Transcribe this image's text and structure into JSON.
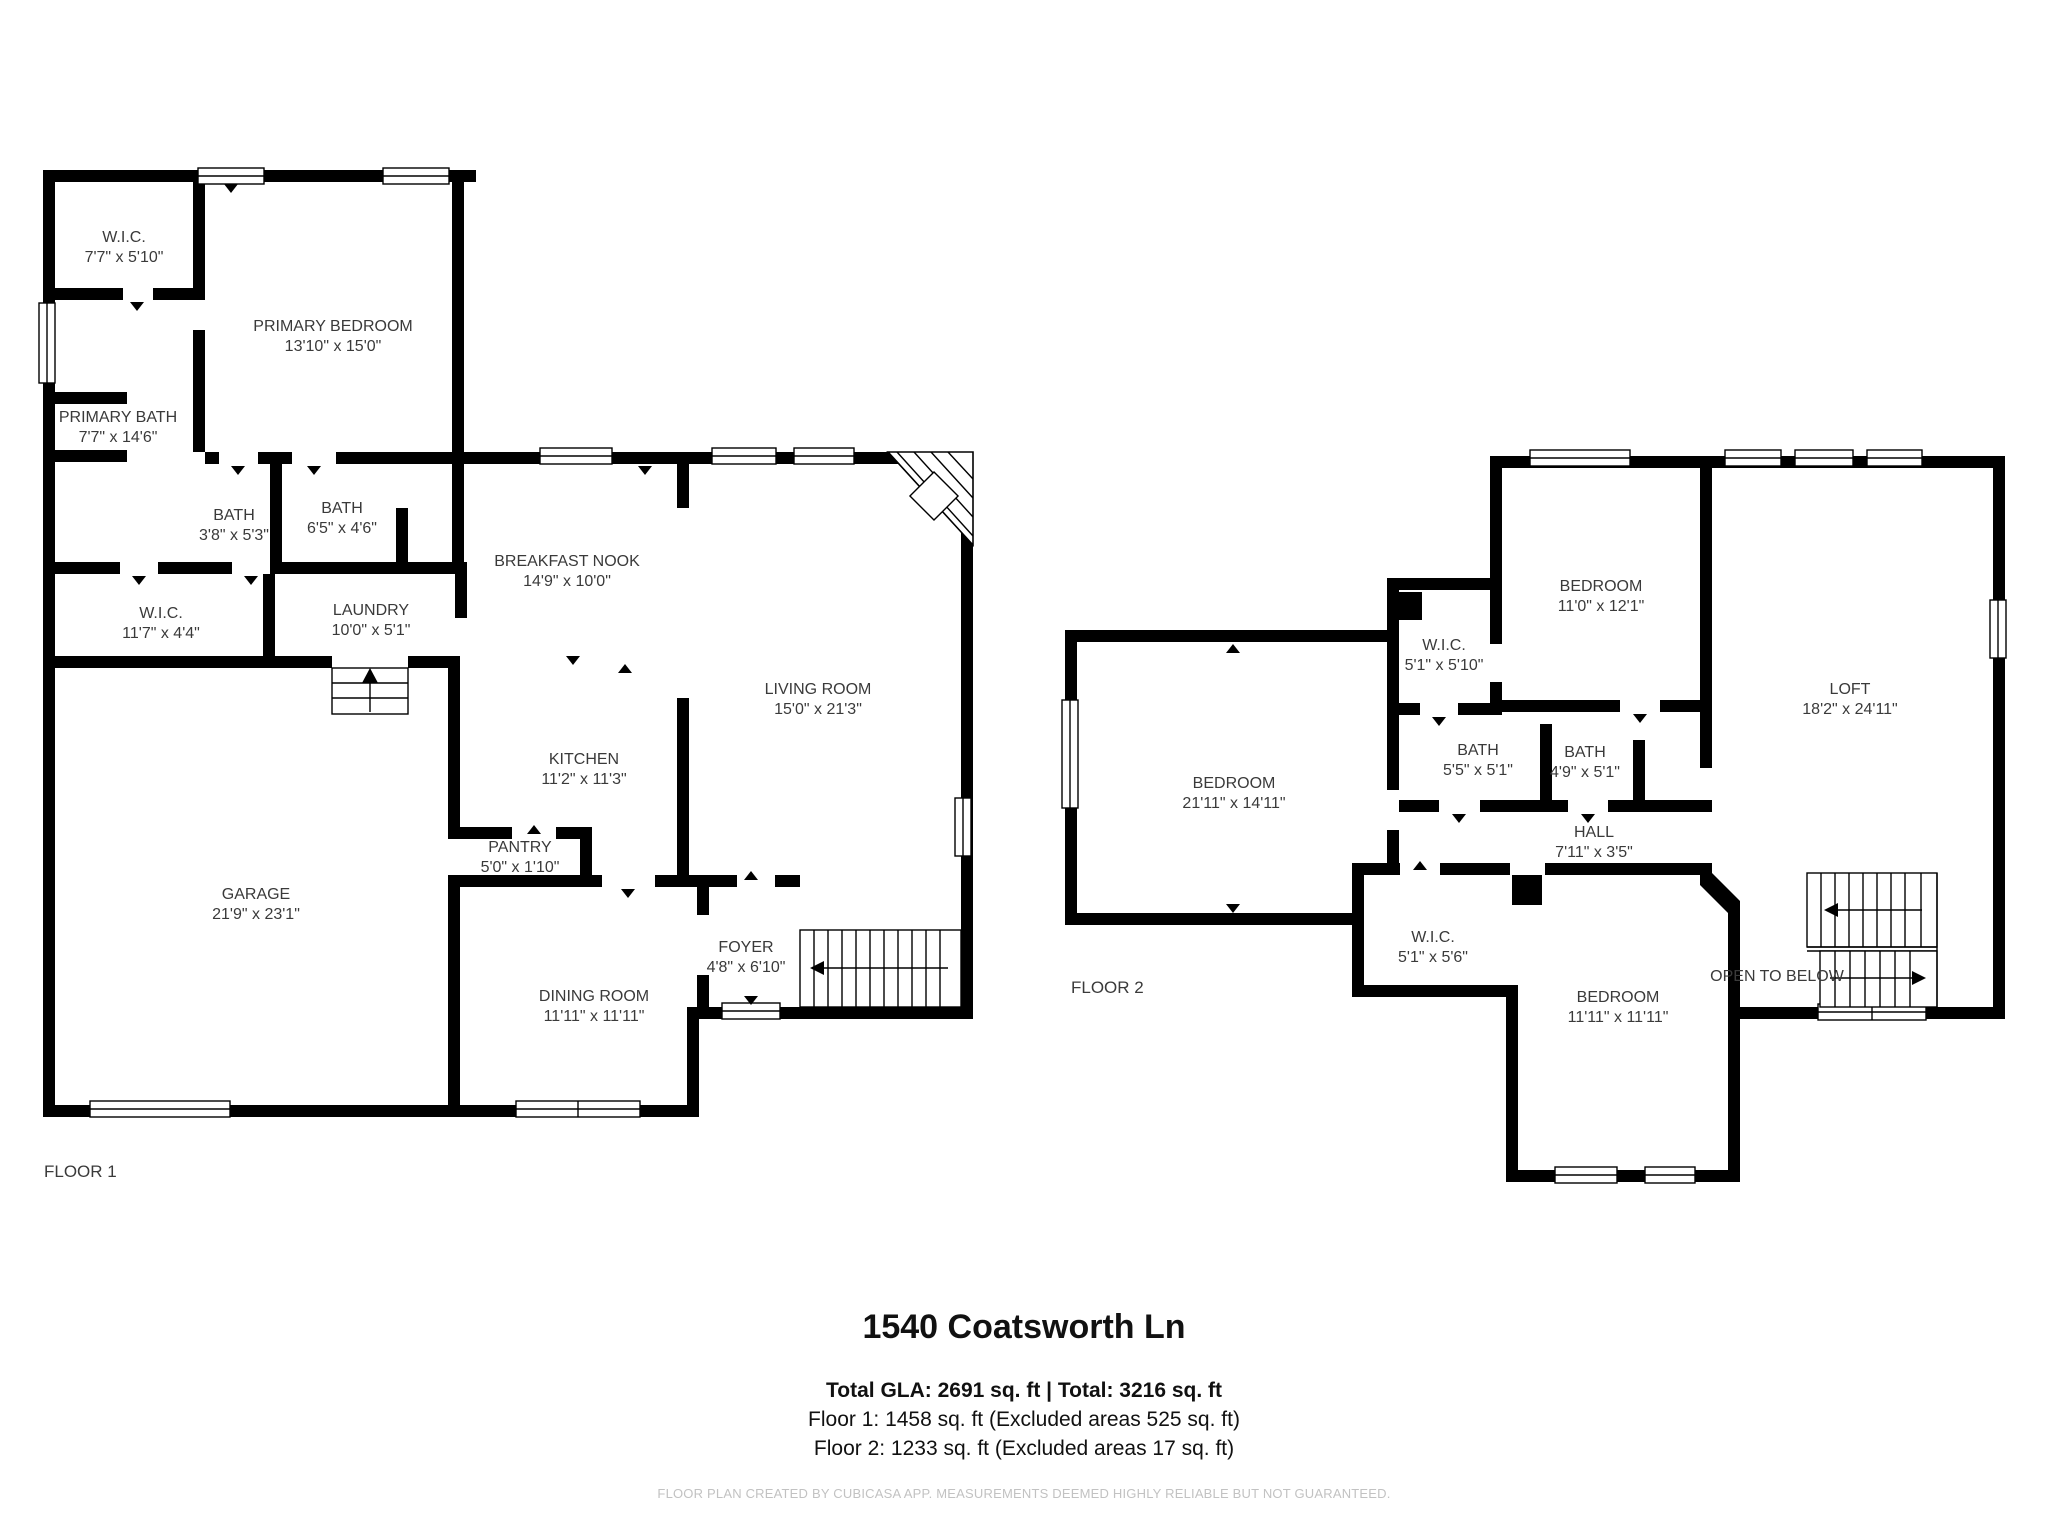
{
  "page": {
    "title": "1540 Coatsworth Ln",
    "summary_total": "Total GLA: 2691 sq. ft | Total: 3216 sq. ft",
    "summary_floor1": "Floor 1: 1458 sq. ft (Excluded areas 525 sq. ft)",
    "summary_floor2": "Floor 2: 1233 sq. ft (Excluded areas 17 sq. ft)",
    "footer": "FLOOR PLAN CREATED BY CUBICASA APP. MEASUREMENTS DEEMED HIGHLY RELIABLE BUT NOT GUARANTEED."
  },
  "colors": {
    "walls": "#000000",
    "room_text": "#3a3a3a",
    "footer_text": "#c2c2c2",
    "background": "#ffffff"
  },
  "floors": [
    {
      "label": "FLOOR 1",
      "rooms": [
        {
          "name": "W.I.C.",
          "dims": "7'7\" x 5'10\"",
          "x": 124,
          "y": 248
        },
        {
          "name": "PRIMARY BEDROOM",
          "dims": "13'10\" x 15'0\"",
          "x": 333,
          "y": 337
        },
        {
          "name": "PRIMARY BATH",
          "dims": "7'7\" x 14'6\"",
          "x": 118,
          "y": 428
        },
        {
          "name": "BATH",
          "dims": "3'8\" x 5'3\"",
          "x": 234,
          "y": 526
        },
        {
          "name": "BATH",
          "dims": "6'5\" x 4'6\"",
          "x": 342,
          "y": 519
        },
        {
          "name": "W.I.C.",
          "dims": "11'7\" x 4'4\"",
          "x": 161,
          "y": 624
        },
        {
          "name": "LAUNDRY",
          "dims": "10'0\" x 5'1\"",
          "x": 371,
          "y": 621
        },
        {
          "name": "BREAKFAST NOOK",
          "dims": "14'9\" x 10'0\"",
          "x": 567,
          "y": 572
        },
        {
          "name": "LIVING ROOM",
          "dims": "15'0\" x 21'3\"",
          "x": 818,
          "y": 700
        },
        {
          "name": "KITCHEN",
          "dims": "11'2\" x 11'3\"",
          "x": 584,
          "y": 770
        },
        {
          "name": "PANTRY",
          "dims": "5'0\" x 1'10\"",
          "x": 520,
          "y": 858
        },
        {
          "name": "GARAGE",
          "dims": "21'9\" x 23'1\"",
          "x": 256,
          "y": 905
        },
        {
          "name": "FOYER",
          "dims": "4'8\" x 6'10\"",
          "x": 746,
          "y": 958
        },
        {
          "name": "DINING ROOM",
          "dims": "11'11\" x 11'11\"",
          "x": 594,
          "y": 1007
        }
      ]
    },
    {
      "label": "FLOOR 2",
      "open_to_below": "OPEN TO BELOW",
      "rooms": [
        {
          "name": "BEDROOM",
          "dims": "11'0\" x 12'1\"",
          "x": 1601,
          "y": 597
        },
        {
          "name": "W.I.C.",
          "dims": "5'1\" x 5'10\"",
          "x": 1444,
          "y": 656
        },
        {
          "name": "LOFT",
          "dims": "18'2\" x 24'11\"",
          "x": 1850,
          "y": 700
        },
        {
          "name": "BATH",
          "dims": "5'5\" x 5'1\"",
          "x": 1478,
          "y": 761
        },
        {
          "name": "BATH",
          "dims": "4'9\" x 5'1\"",
          "x": 1585,
          "y": 763
        },
        {
          "name": "BEDROOM",
          "dims": "21'11\" x 14'11\"",
          "x": 1234,
          "y": 794
        },
        {
          "name": "HALL",
          "dims": "7'11\" x 3'5\"",
          "x": 1594,
          "y": 843
        },
        {
          "name": "W.I.C.",
          "dims": "5'1\" x 5'6\"",
          "x": 1433,
          "y": 948
        },
        {
          "name": "BEDROOM",
          "dims": "11'11\" x 11'11\"",
          "x": 1618,
          "y": 1008
        }
      ]
    }
  ]
}
